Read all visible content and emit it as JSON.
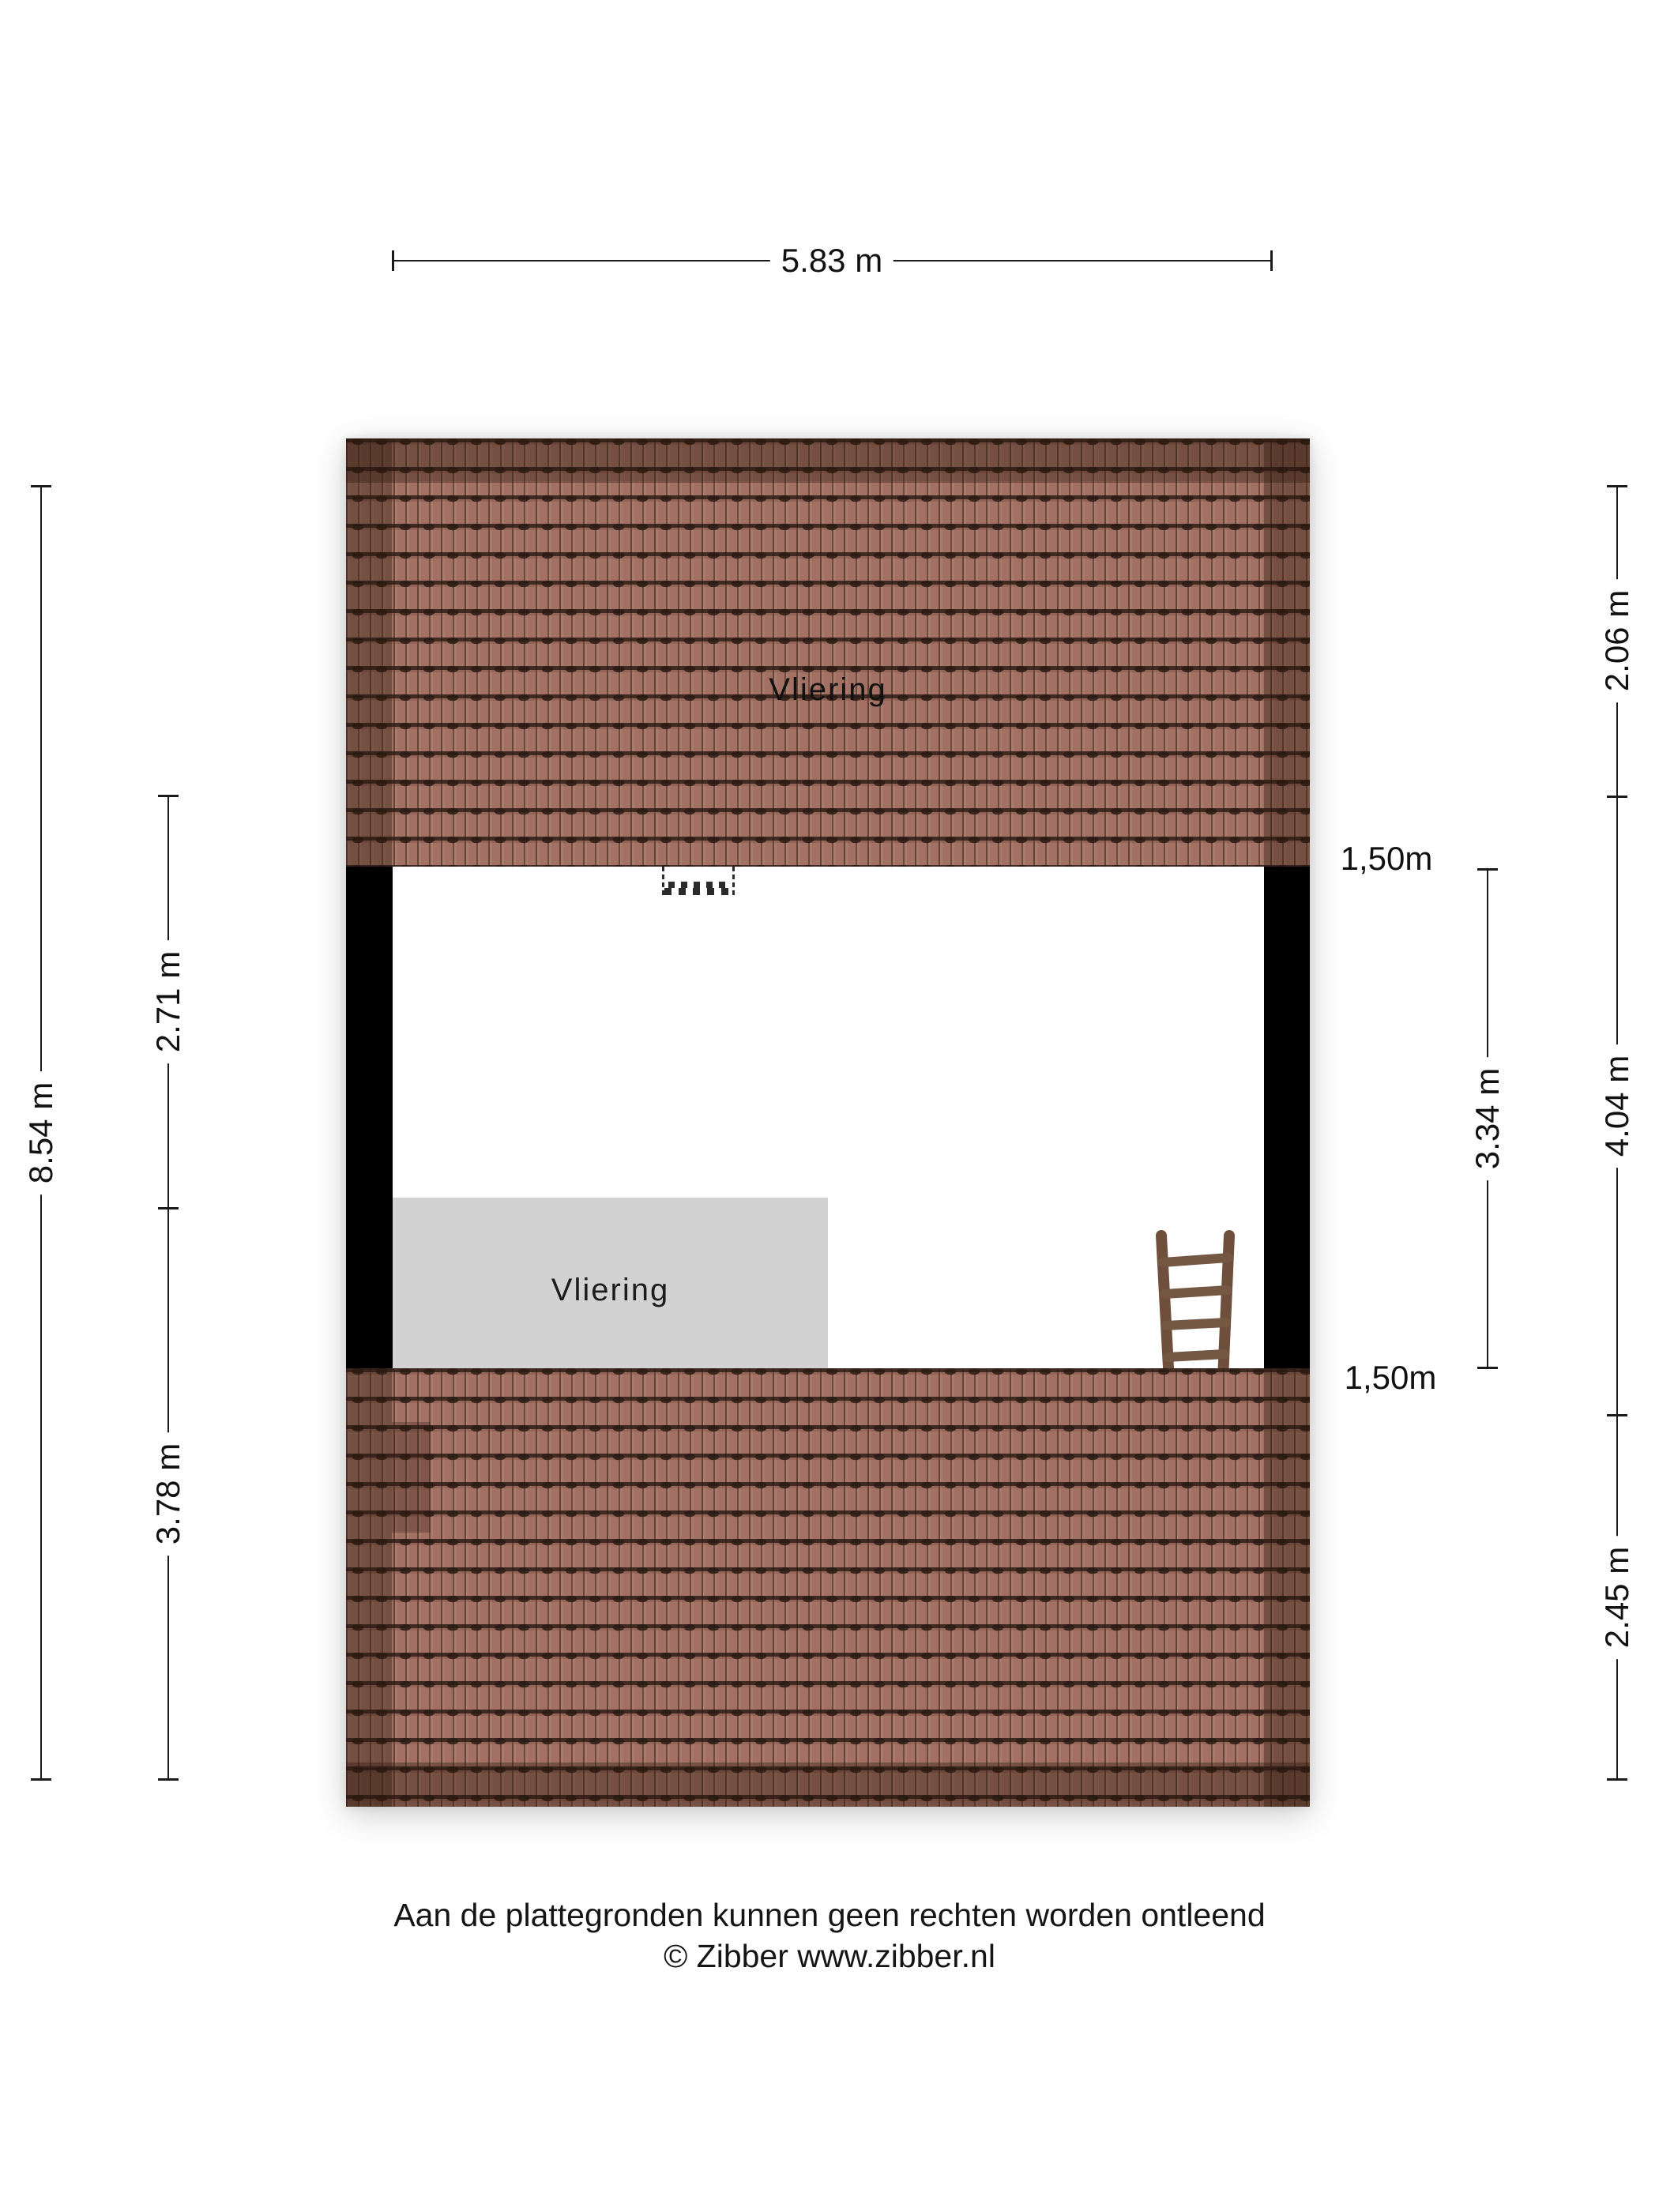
{
  "plan": {
    "upper_roof_label": "Vliering",
    "platform_label": "Vliering"
  },
  "dims": {
    "top_width": "5.83 m",
    "left_total": "8.54 m",
    "left_upper": "2.71 m",
    "left_lower": "3.78 m",
    "right_inner": "3.34 m",
    "right_top": "2.06 m",
    "right_mid": "4.04 m",
    "right_bottom": "2.45 m",
    "knee_top": "1,50m",
    "knee_bottom": "1,50m"
  },
  "footer": {
    "disclaimer": "Aan de plattegronden kunnen geen rechten worden ontleend",
    "copyright": "© Zibber www.zibber.nl"
  },
  "colors": {
    "roof_tile": "#a27163",
    "roof_edge_shade": "rgba(46,24,14,0.38)",
    "wall": "#000000",
    "platform_gray": "#d2d2d2",
    "dimension_line": "#1a1a1a",
    "ladder_wood": "#6d4f3c"
  }
}
